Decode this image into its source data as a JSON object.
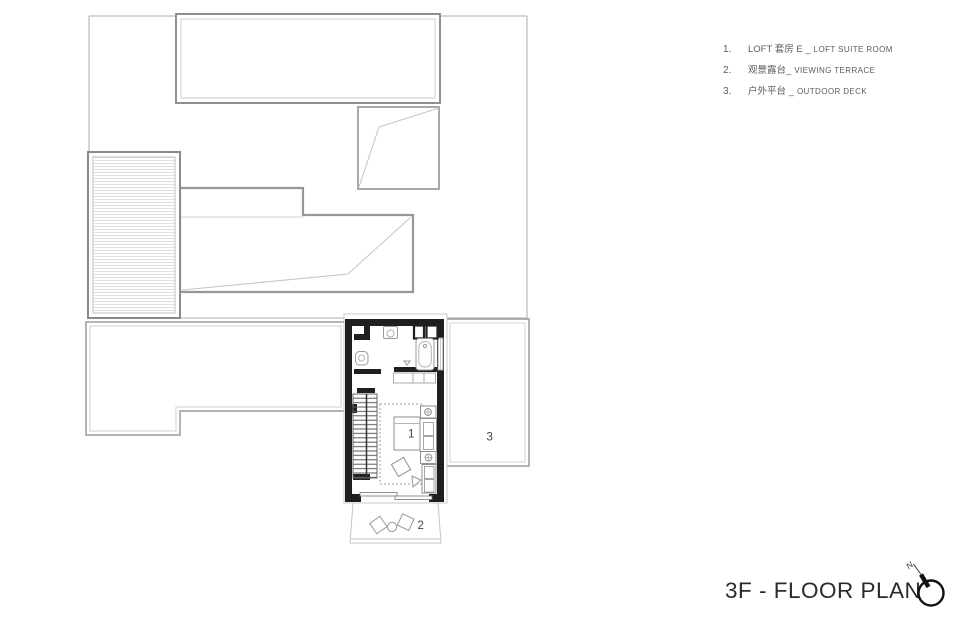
{
  "legend": {
    "items": [
      {
        "num": "1.",
        "zh": "LOFT 套房 E _",
        "en": "LOFT SUITE ROOM"
      },
      {
        "num": "2.",
        "zh": "观景露台_",
        "en": "VIEWING TERRACE"
      },
      {
        "num": "3.",
        "zh": "户外平台 _",
        "en": "OUTDOOR DECK"
      }
    ]
  },
  "plan": {
    "labels": {
      "suite": "1",
      "terrace": "2",
      "deck": "3"
    },
    "colors": {
      "wall": "#1f1f1f",
      "roof_outline": "#979797",
      "light_outline": "#bdbdbd",
      "fixture": "#9a9a9a",
      "label_text": "#444444"
    }
  },
  "title": {
    "text": "3F - FLOOR PLAN"
  },
  "compass": {
    "north_label": "N"
  }
}
